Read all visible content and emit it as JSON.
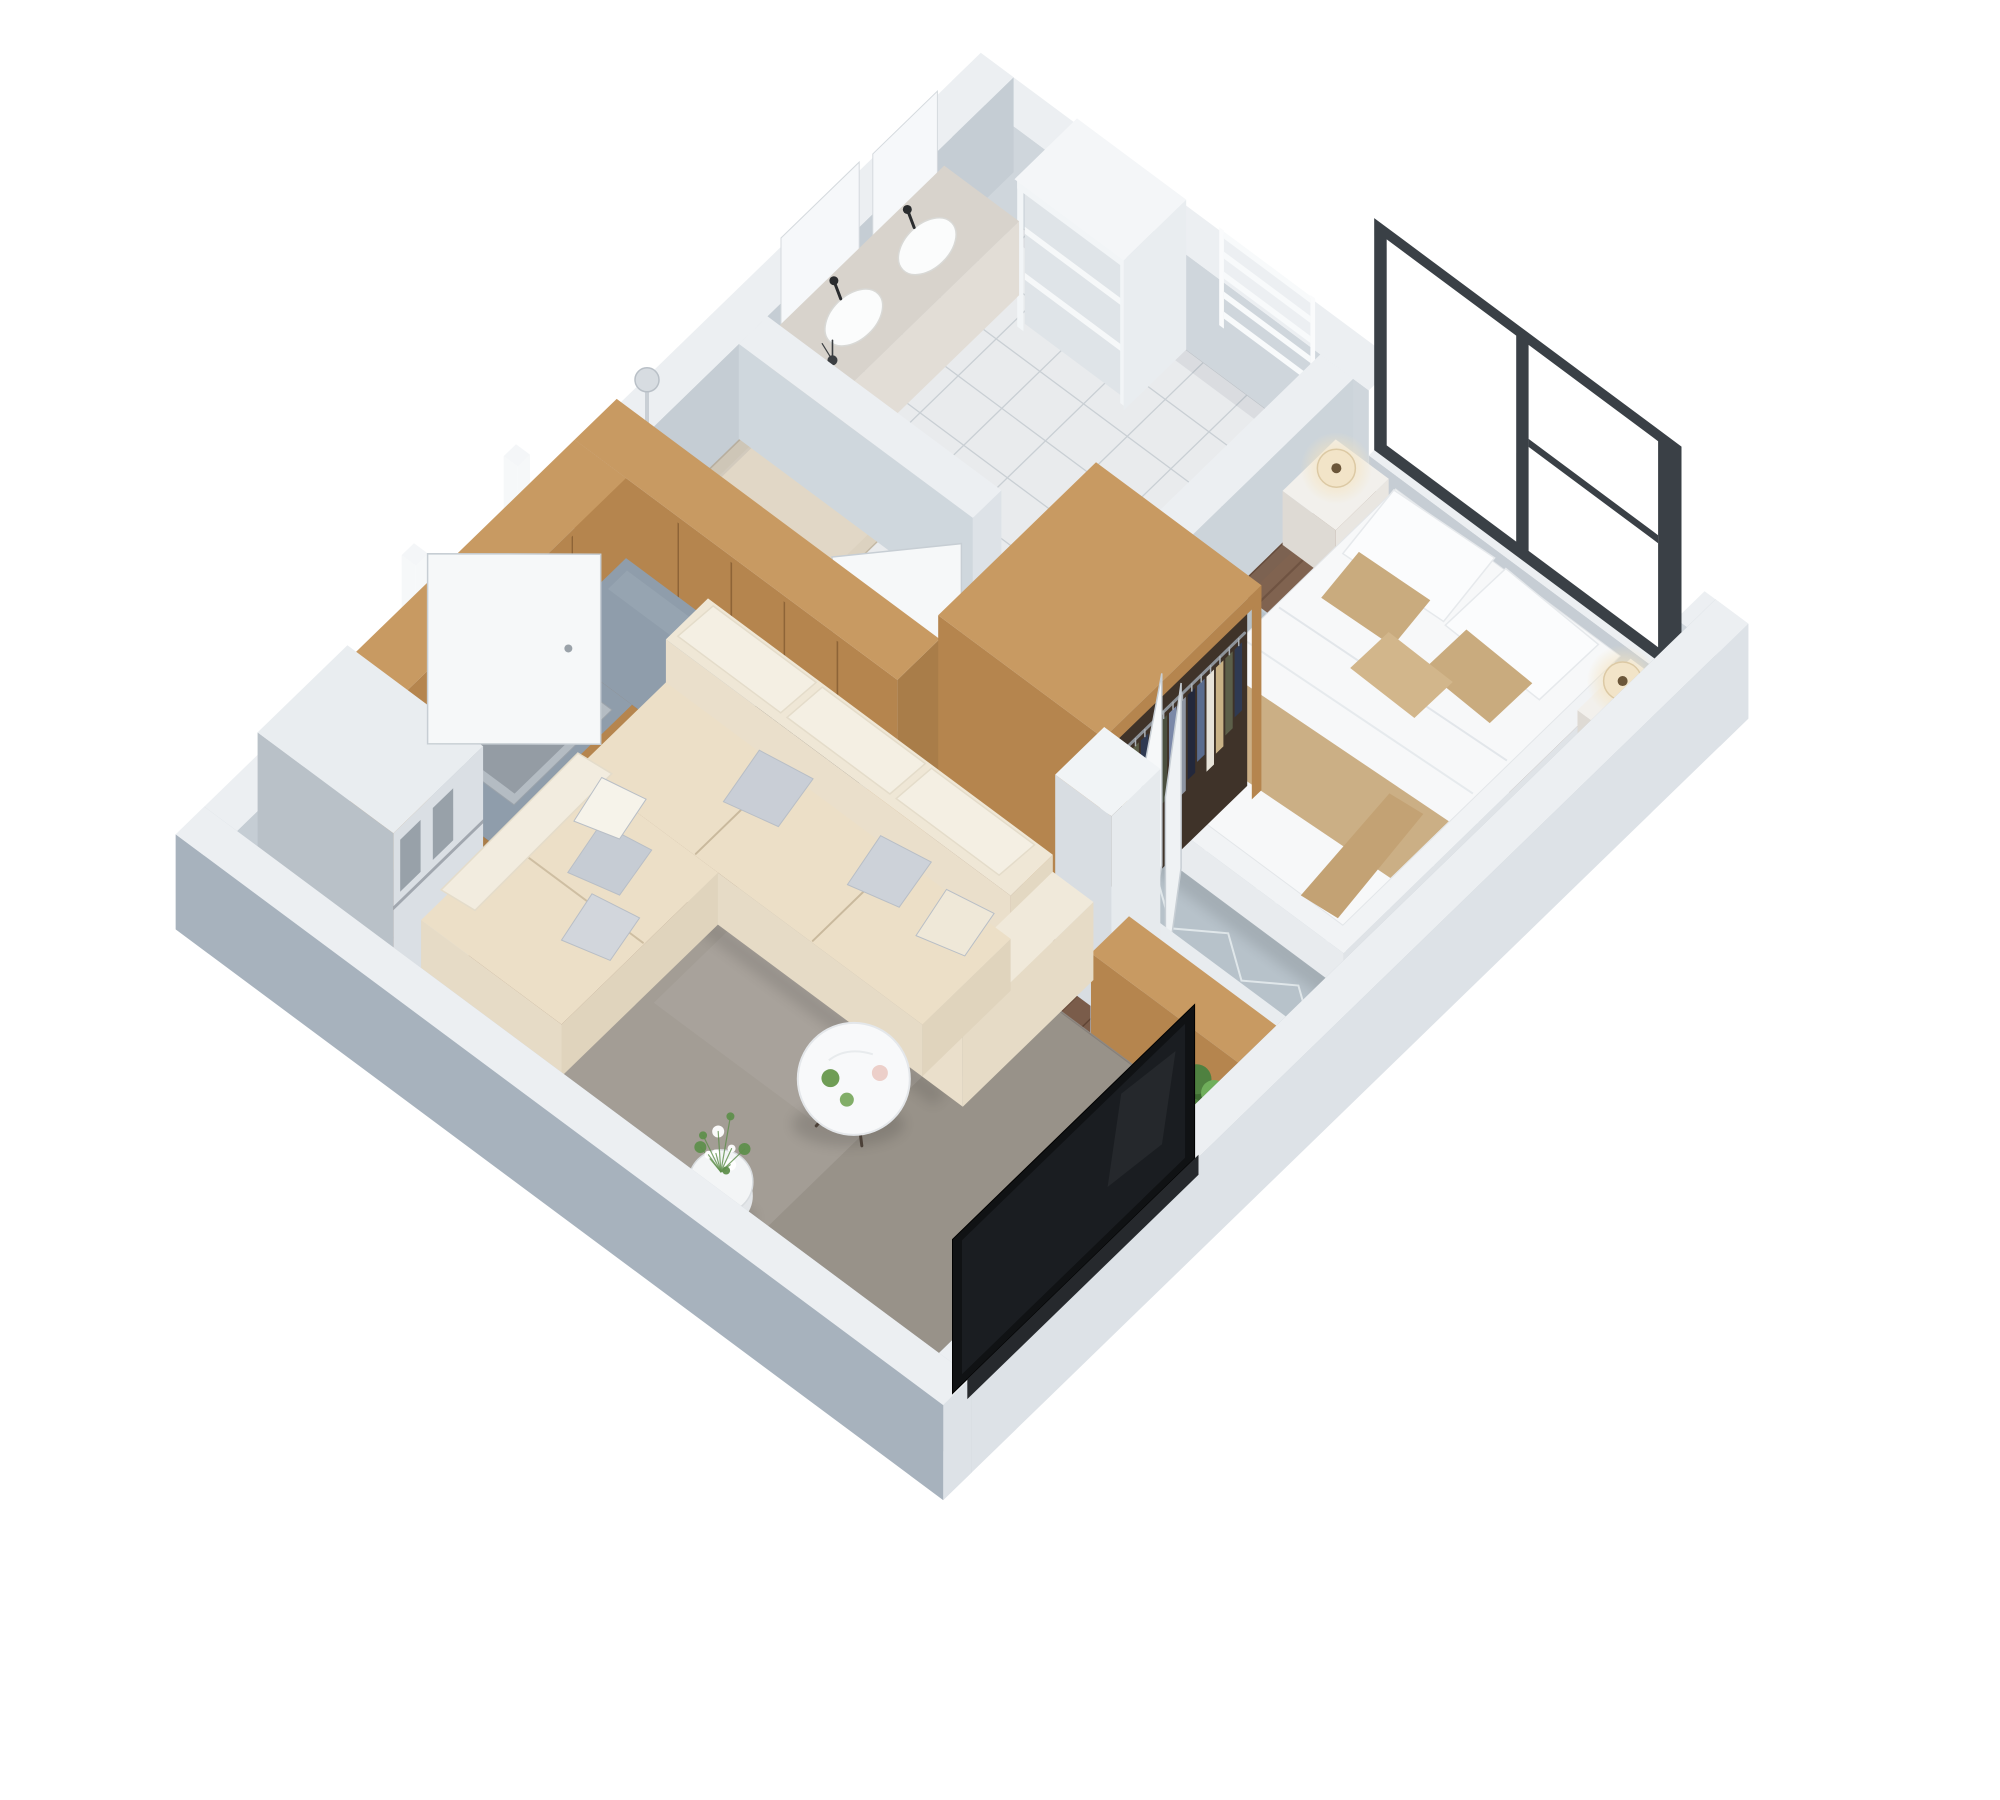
{
  "scene": {
    "title": "3D isometric floor plan render — one-bedroom apartment",
    "background": "#ffffff",
    "view": "axonometric top-down, plan rotated 45 degrees"
  },
  "rooms": [
    {
      "name": "bathroom",
      "floor": "white ceramic tile",
      "position": "top corner"
    },
    {
      "name": "shower-area",
      "floor": "travertine",
      "position": "left of bathroom"
    },
    {
      "name": "bedroom",
      "floor": "dark wood",
      "position": "right corner"
    },
    {
      "name": "kitchen",
      "floor": "dark wood",
      "position": "left corner"
    },
    {
      "name": "hallway-dressing",
      "floor": "tile + wood",
      "position": "center"
    },
    {
      "name": "living-room",
      "floor": "dark wood",
      "position": "bottom corner"
    }
  ],
  "inventory": {
    "bathroom": [
      "vanity with two vessel sinks",
      "black faucets",
      "wall mirror panels",
      "open shelf unit",
      "towel radiator",
      "toilet",
      "shower column"
    ],
    "bedroom": [
      "double bed with white bedding",
      "tan accent pillows and runner",
      "nightstand left",
      "nightstand right",
      "drum table lamps",
      "chevron area rug",
      "dark framed window"
    ],
    "kitchen": [
      "L-shaped wood cabinets",
      "tall upper cabinet band",
      "granite countertop",
      "stainless sink",
      "black induction cooktop",
      "fridge"
    ],
    "hallway-dressing": [
      "open wardrobe with hanging clothes",
      "two white wardrobe doors",
      "bathroom door",
      "bedroom door"
    ],
    "living-room": [
      "cream corner sofa",
      "grey throw pillows",
      "round marble coffee table",
      "white planter with flowers",
      "TV panel",
      "half wall with wood console bench",
      "green plant",
      "entrance door"
    ]
  },
  "palette": {
    "bg": "#ffffff",
    "wallTop": "#eceff2",
    "wallInnerNE": "#cfd6dc",
    "wallInnerNW": "#c5cdd4",
    "wallInnerSE": "#aab4be",
    "wallInnerSW": "#c2cad2",
    "wallOuterBright": "#dde2e7",
    "wallOuterShadow": "#a7b2bd",
    "floorWood": "#7a5c4a",
    "plankLine": "#3a2315",
    "floorTile": "#e9ebed",
    "grout": "#c9cfd4",
    "travertine": "#dcd2c0",
    "granite": "#8f9dab",
    "woodTop": "#c89a62",
    "woodFront": "#b5854e",
    "doorWhite": "#f6f8f9",
    "doorEdge": "#c7ced4",
    "windowFrame": "#3a4046",
    "rugBed": "#b7c2ca",
    "rugBedLine": "#e7edf0",
    "rugLiving": "#a39d95",
    "sofaTop": "#ecdfc7",
    "sofaFront": "#e6dbc6",
    "sofaSide": "#e0d4bd",
    "sofaBack": "#eadfcb",
    "cushionCream": "#f4efe3",
    "pillowGrey": "#c9ced6",
    "tan": "#c8ab7e",
    "white": "#f4f6f8",
    "steelFront": "#dadfe4",
    "steelSide": "#b9c1c8",
    "black": "#141619",
    "lampGlow": "#f7ead0",
    "lampBody": "#f2e4c8",
    "green1": "#3d6a31",
    "green2": "#4f8140",
    "green3": "#6fae5b"
  },
  "clothesColors": [
    "#2f3a52",
    "#5c5f49",
    "#c9b286",
    "#e7e3d9",
    "#5a6c8e",
    "#23283b",
    "#8d95a2",
    "#7b88a8",
    "#4a4f3f",
    "#d9cdb4"
  ]
}
